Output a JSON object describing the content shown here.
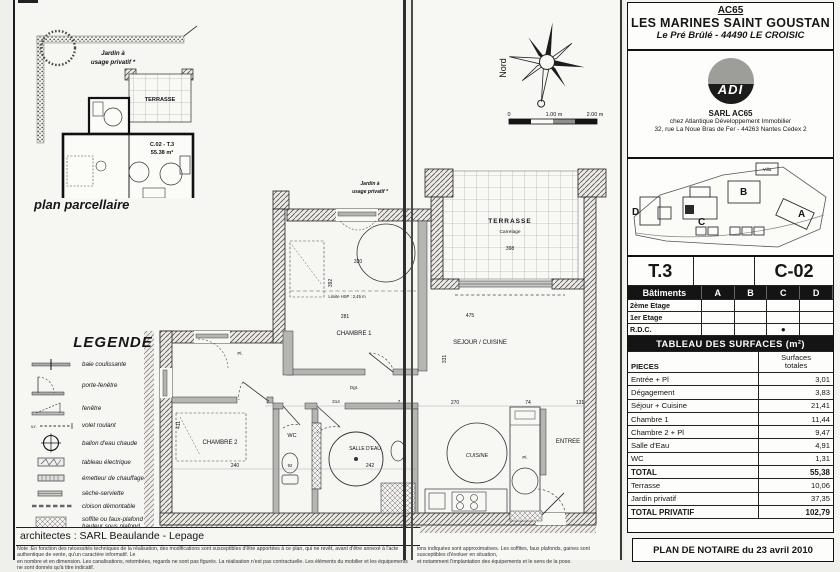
{
  "header": {
    "ref": "AC65",
    "title": "LES MARINES SAINT GOUSTAN",
    "subtitle": "Le Pré Brûlé - 44490 LE CROISIC"
  },
  "developer": {
    "logo": "ADI",
    "company": "SARL AC65",
    "line1": "chez Atlantique Développement Immobilier",
    "line2": "32, rue La Noue Bras de Fer - 44263 Nantes Cedex 2"
  },
  "site_plan": {
    "buildings": [
      "A",
      "B",
      "C",
      "D"
    ],
    "villa": "Villa"
  },
  "unit_card": {
    "type": "T.3",
    "code": "C-02"
  },
  "buildings_table": {
    "col_label": "Bâtiments",
    "cols": [
      "A",
      "B",
      "C",
      "D"
    ],
    "rows": [
      "2ème Etage",
      "1er Etage",
      "R.D.C."
    ],
    "marker": "●"
  },
  "surfaces_table": {
    "title": "TABLEAU DES SURFACES (m²)",
    "header_left": "PIECES",
    "header_right": "Surfaces\ntotales",
    "rows": [
      {
        "label": "Entrée + Pl",
        "value": "3,01"
      },
      {
        "label": "Dégagement",
        "value": "3,83"
      },
      {
        "label": "Séjour + Cuisine",
        "value": "21,41"
      },
      {
        "label": "Chambre 1",
        "value": "11,44"
      },
      {
        "label": "Chambre 2 + Pl",
        "value": "9,47"
      },
      {
        "label": "Salle d'Eau",
        "value": "4,91"
      },
      {
        "label": "WC",
        "value": "1,31"
      },
      {
        "label": "TOTAL",
        "value": "55,38"
      },
      {
        "label": "Terrasse",
        "value": "10,06"
      },
      {
        "label": "Jardin privatif",
        "value": "37,35"
      },
      {
        "label": "TOTAL PRIVATIF",
        "value": "102,79"
      }
    ]
  },
  "notary": "PLAN DE NOTAIRE du 23 avril 2010",
  "parcel": {
    "garden_line1": "Jardin à",
    "garden_line2": "usage privatif *",
    "terrace": "TERRASSE",
    "unit": "C.02 - T.3",
    "area": "55.38 m²",
    "caption": "plan parcellaire"
  },
  "compass": {
    "north": "Nord"
  },
  "scale_bar": {
    "zero": "0",
    "one": "1.00 m",
    "two": "2.00 m"
  },
  "legend": {
    "title": "LEGENDE",
    "items": [
      "baie coulissante",
      "porte-fenêtre",
      "fenêtre",
      "volet roulant",
      "ballon d'eau chaude",
      "tableau électrique",
      "émetteur de chauffage",
      "sèche-serviette",
      "cloison démontable",
      "soffite ou faux-plafond\nhauteur sous plafond\nréduite"
    ]
  },
  "architects": "architectes : SARL Beaulande - Lepage",
  "notes": {
    "left1": "Note :En fonction des nécessités techniques de la réalisation, des modifications sont susceptibles d'être apportées à ce plan, qui ne revêt, avant d'être annexé à l'acte authentique de vente, qu'un caractère informatif. Le",
    "left2": "en nombre et en dimension. Les canalisations, retombées, regards ne sont pas figurés. La réalisation n'est pas contractuelle. Les éléments du mobilier et les équipements ne sont donnés qu'à titre indicatif.",
    "right1": "ions indiquées sont approximatives. Les soffites, faux plafonds, gaines sont susceptibles d'évoluer en situation,",
    "right2": "et notamment l'implantation des équipements et le sens de la pose."
  },
  "plan": {
    "rooms": {
      "jardin1": "Jardin à",
      "jardin2": "usage privatif *",
      "terrasse": "TERRASSE",
      "terrasse_sub": "Carrelage",
      "chambre1": "CHAMBRE 1",
      "chambre2": "CHAMBRE 2",
      "wc": "WC",
      "salle_eau": "SALLE D'EAU",
      "sejour": "SEJOUR / CUISINE",
      "cuisine": "CUISINE",
      "entree": "ENTREE",
      "dgt": "Dgt.",
      "pl_hall": "Pl.",
      "pl_entree": "Pl.",
      "hsp": "Limite HSP : 2,45 m"
    },
    "dims": {
      "d320": "320",
      "d281": "281",
      "d392": "392",
      "d475": "475",
      "d398": "398",
      "d331": "331",
      "d240": "240",
      "d411": "411",
      "d92": "92",
      "d242": "242",
      "d314": "314",
      "d7a": "7",
      "d7b": "7",
      "d270": "270",
      "d74": "74",
      "d131": "131"
    }
  }
}
